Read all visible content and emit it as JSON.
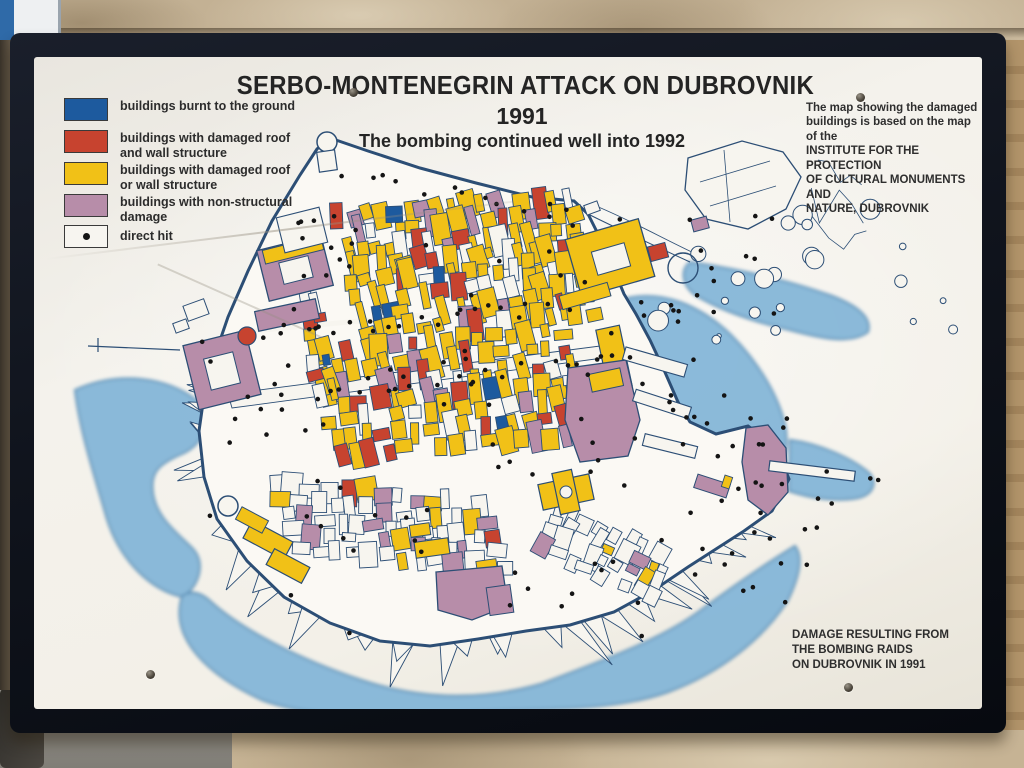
{
  "sign": {
    "title": "SERBO-MONTENEGRIN ATTACK ON DUBROVNIK",
    "year": "1991",
    "subtitle": "The bombing continued well into 1992"
  },
  "legend": {
    "items": [
      {
        "label": "buildings burnt to the ground",
        "color": "#1d5a9e",
        "type": "fill"
      },
      {
        "label": "buildings with damaged roof\nand wall structure",
        "color": "#c7432f",
        "type": "fill"
      },
      {
        "label": "buildings with damaged roof\nor wall structure",
        "color": "#f1c117",
        "type": "fill"
      },
      {
        "label": "buildings with non-structural\ndamage",
        "color": "#b78da9",
        "type": "fill"
      },
      {
        "label": "direct hit",
        "color": "#141414",
        "type": "dot"
      }
    ]
  },
  "notes": {
    "source": "The map showing the damaged\nbuildings is based on the map of the\nINSTITUTE FOR THE PROTECTION\nOF CULTURAL MONUMENTS AND\nNATURE, DUBROVNIK",
    "caption": "DAMAGE RESULTING FROM\nTHE BOMBING RAIDS\nON DUBROVNIK IN 1991"
  },
  "map": {
    "colors": {
      "line": "#2c4e75",
      "water": "#82b5d8",
      "water_edge": "#4f88b4",
      "ground": "#fbf9f4",
      "building_white": "#f7f5ef",
      "burnt": "#1d5a9e",
      "roof_wall": "#c7432f",
      "roof": "#f1c117",
      "nonstructural": "#b78da9",
      "hit": "#141414"
    }
  }
}
